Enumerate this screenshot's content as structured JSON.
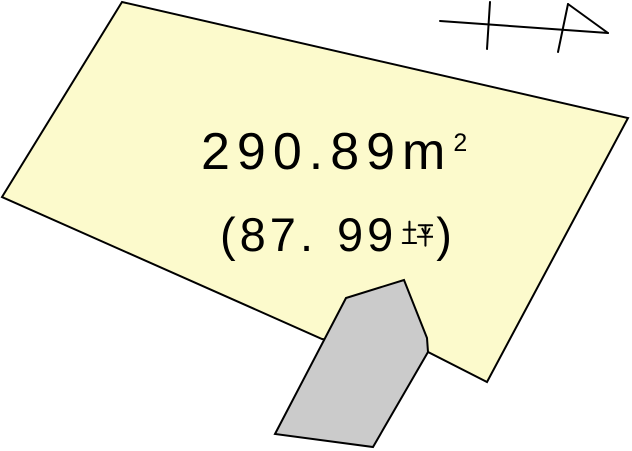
{
  "colors": {
    "background": "#FFFFFF",
    "parcel_fill": "#FCFACC",
    "annex_fill": "#CBCBCB",
    "outline": "#000000",
    "text": "#000000"
  },
  "parcel": {
    "area_sqm": {
      "value": "290.89",
      "unit_base": "m",
      "unit_exponent": "2",
      "full_text": "290.89m2"
    },
    "area_tsubo": {
      "open_paren": "(",
      "integer_part": "87",
      "decimal_point": ".",
      "fraction_part": "99",
      "unit": "坪",
      "close_paren": ")",
      "full_text": "(87.99坪)"
    }
  },
  "icons": {
    "north_arrow": "north-arrow-icon",
    "tsubo_kanji": "坪"
  }
}
